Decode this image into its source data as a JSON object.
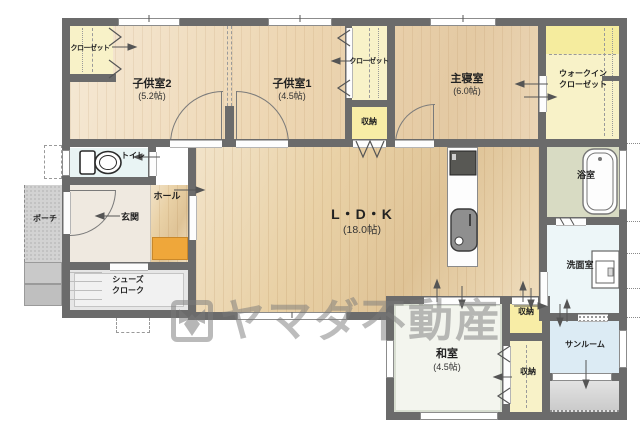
{
  "title": "間取り図",
  "watermark": {
    "brand": "ヤマダ不動産"
  },
  "rooms": {
    "kids2": {
      "name": "子供室2",
      "size": "(5.2帖)"
    },
    "kids1": {
      "name": "子供室1",
      "size": "(4.5帖)"
    },
    "master": {
      "name": "主寝室",
      "size": "(6.0帖)"
    },
    "wic": {
      "line1": "ウォークイン",
      "line2": "クローゼット"
    },
    "ldk": {
      "name": "L・D・K",
      "size": "(18.0帖)"
    },
    "washitsu": {
      "name": "和室",
      "size": "(4.5帖)"
    },
    "bath": {
      "name": "浴室"
    },
    "laundry": {
      "name": "洗面室"
    },
    "sunroom": {
      "name": "サンルーム"
    },
    "toilet": {
      "name": "トイレ"
    },
    "hall": {
      "name": "ホール"
    },
    "entry": {
      "name": "玄関"
    },
    "porch": {
      "name": "ポーチ"
    },
    "shoecloset": {
      "line1": "シューズ",
      "line2": "クローク"
    },
    "closet_nw": {
      "name": "クローゼット"
    },
    "closet_mid": {
      "name": "クローゼット"
    },
    "storage_mid": {
      "name": "収納"
    },
    "storage_e1": {
      "name": "収納"
    },
    "storage_e2": {
      "name": "収納"
    }
  },
  "colors": {
    "wall": "#6b6b6b",
    "wood_floor": "#e9d1a6",
    "closet_yellow": "#f8f2c8",
    "storage_yellow": "#f8eda6",
    "water_blue": "#e6f2f2",
    "sunroom_blue": "#dcebf4",
    "bath_green": "#d8dbc3",
    "shoe_cabinet_orange": "#efa73a",
    "watermark_gray": "#7a7a7a"
  }
}
